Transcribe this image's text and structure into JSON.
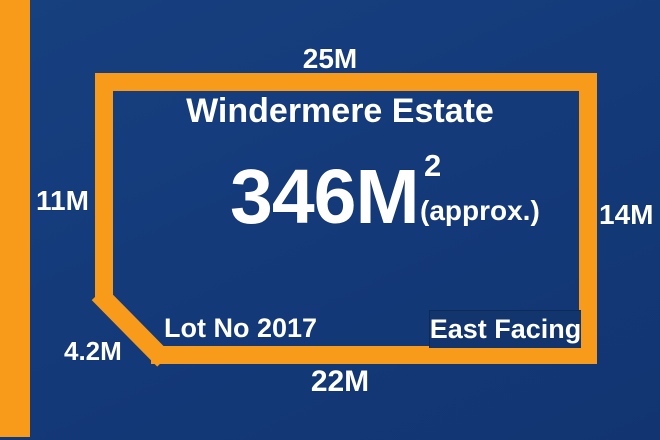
{
  "colors": {
    "background": "#143A7A",
    "accent_orange": "#F89B1A",
    "text": "#FFFFFF",
    "facing_box_fill": "#12356E",
    "facing_box_border": "#0C2B5B"
  },
  "estate": {
    "name": "Windermere Estate",
    "area_value": "346M",
    "area_superscript": "2",
    "area_approx": "(approx.)",
    "lot_label": "Lot No 2017",
    "facing_label": "East Facing"
  },
  "boundary_dimensions": {
    "top": "25M",
    "left": "11M",
    "right": "14M",
    "bottom": "22M",
    "diagonal": "4.2M"
  }
}
